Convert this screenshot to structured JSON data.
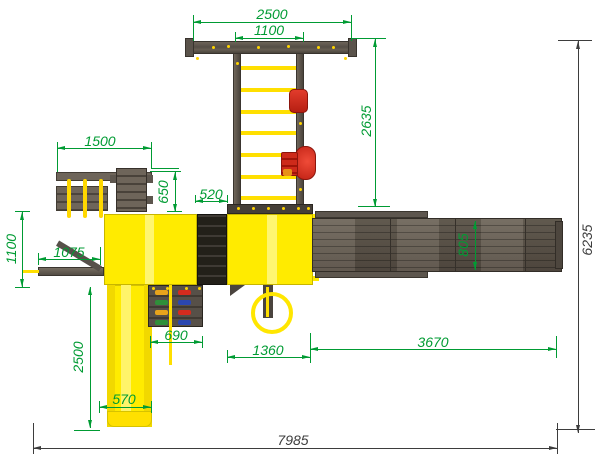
{
  "drawing": {
    "title": "playground-equipment-top-view",
    "units": "mm",
    "colors": {
      "dimension_green": "#009b33",
      "dimension_dark": "#3d3d3d",
      "platform_yellow": "#ffeb00",
      "wood_grey": "#5d564e",
      "accent_red": "#d42b1e"
    },
    "dimensions": {
      "top_beam_length": "2500",
      "ladder_span": "1100",
      "ladder_length": "2635",
      "left_module_width": "1500",
      "left_module_depth": "650",
      "bridge_length": "520",
      "left_beam_offset": "1100",
      "left_beam_length": "1075",
      "slide_length": "2500",
      "climbing_wall_width": "690",
      "slide_width": "570",
      "pole_offset": "1360",
      "swing_beam_length": "3670",
      "swing_beam_width": "805",
      "overall_depth": "6235",
      "overall_width": "7985"
    }
  }
}
